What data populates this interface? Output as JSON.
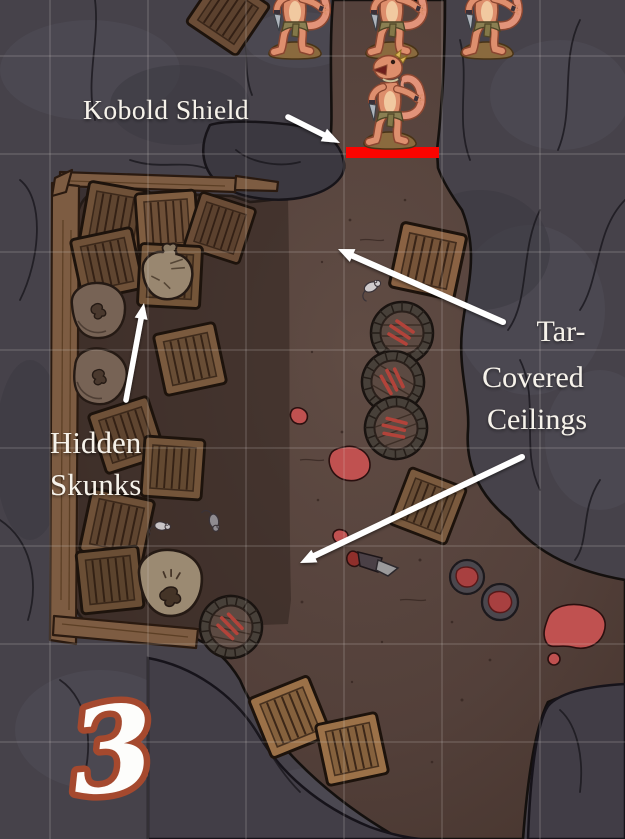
{
  "annotations": {
    "kobold_shield_label": "Kobold Shield",
    "hidden_skunks": {
      "line1": "Hidden",
      "line2": "Skunks"
    },
    "tar_covered_ceilings": {
      "line1": "Tar-",
      "line2": "Covered",
      "line3": "Ceilings"
    },
    "map_number": "3"
  },
  "tokens": {
    "kobold": {
      "name": "kobold",
      "count": 4
    },
    "shield_marker": {
      "name": "kobold-shield-marker",
      "color": "#fb0400"
    }
  },
  "scenery": {
    "crates": 15,
    "barrels": 4,
    "sacks": 4,
    "mice": 3,
    "blood_bowls": 2,
    "blood_pools": 5,
    "hatchet": 1
  },
  "colors": {
    "rock": "#46424a",
    "rock_light": "#53505a",
    "rock_dark": "#3a3740",
    "floor": "#5c4840",
    "floor_edge": "#47352e",
    "room_floor_shade": "#31241f",
    "wood": "#7d5c42",
    "crate_dark": "#6f5138",
    "crate_light": "#9b7148",
    "barrel_top": "#5c4a42",
    "blood": "#c05150",
    "red_bar": "#fb0400",
    "annotation_text": "#f6f2ea",
    "number_fill": "#fdfdfb",
    "number_outline": "#a5492e",
    "grid_line": "#d8d2cc"
  },
  "grid": {
    "cell_size_px": 98,
    "offset_x": 50,
    "offset_y": 56
  }
}
